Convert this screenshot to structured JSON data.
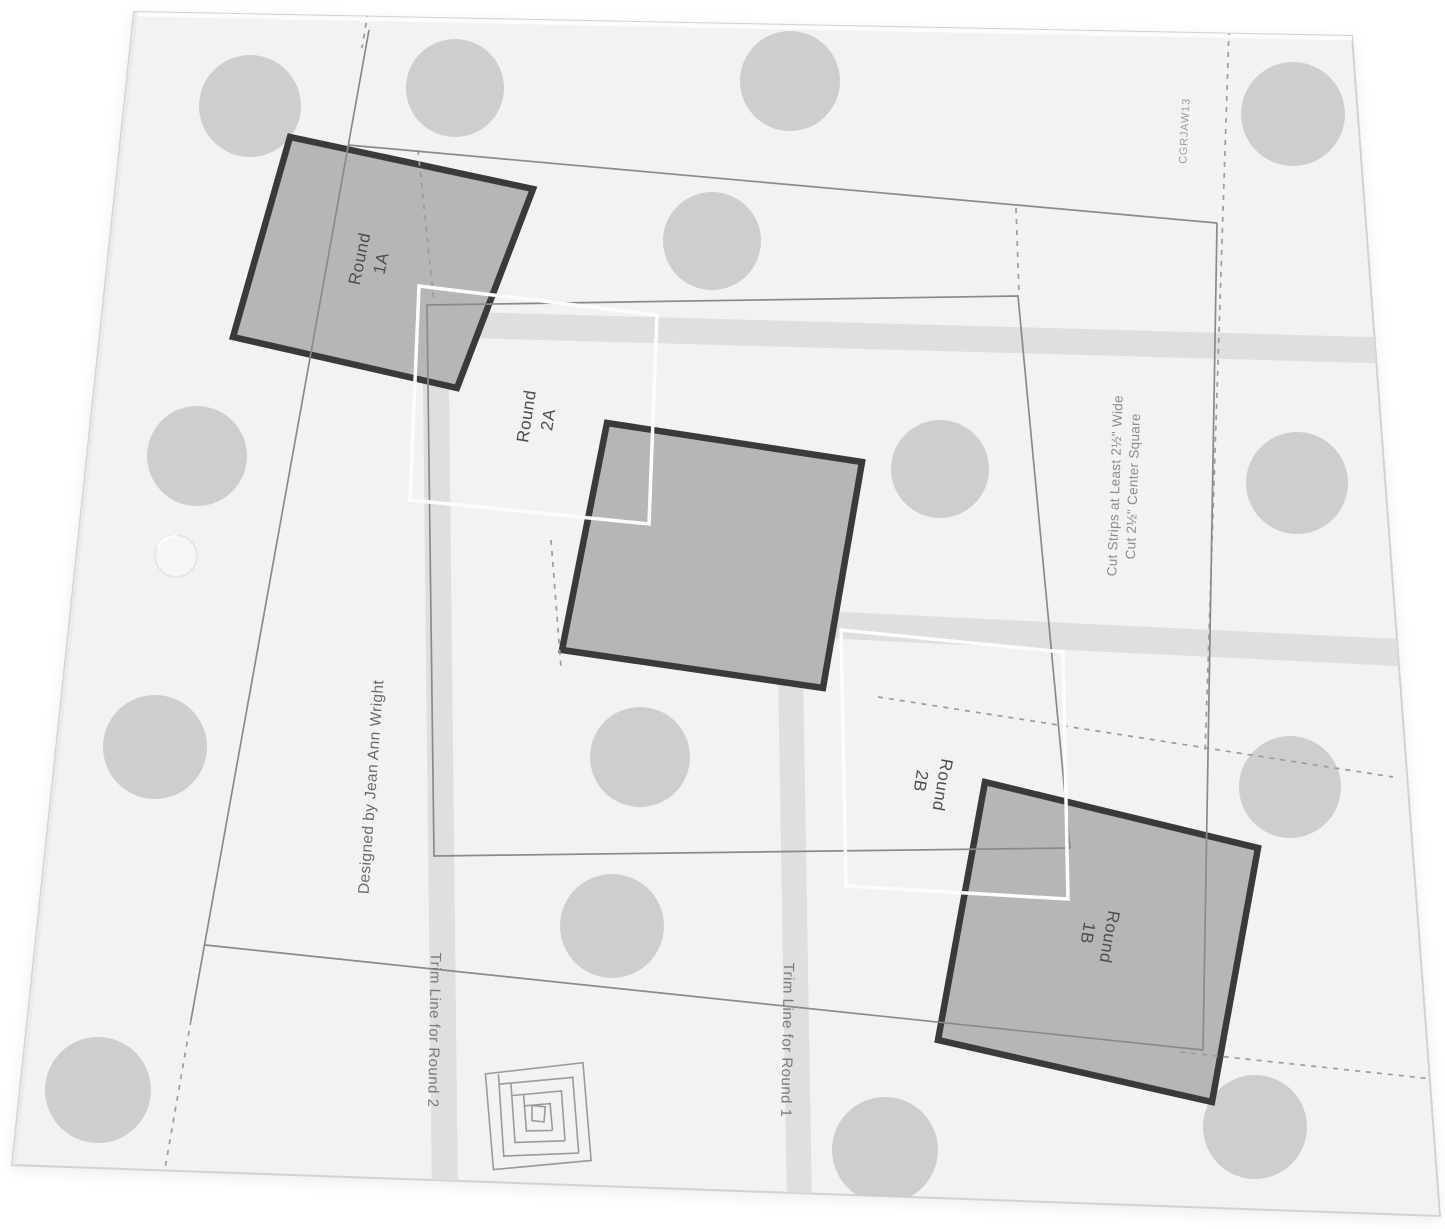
{
  "scene": {
    "description": "Clear acrylic log cabin quilt ruler / trim tool lying on a white background"
  },
  "ruler": {
    "product_code": "CGRJAW13",
    "designer_credit": "Designed by Jean Ann Wright",
    "placement_labels": {
      "round_1a": {
        "line1": "Round",
        "line2": "1A"
      },
      "round_2a": {
        "line1": "Round",
        "line2": "2A"
      },
      "round_2b": {
        "line1": "Round",
        "line2": "2B"
      },
      "round_1b": {
        "line1": "Round",
        "line2": "1B"
      }
    },
    "trim_line_labels": {
      "round_2": "Trim Line for Round 2",
      "round_1": "Trim Line for Round 1"
    },
    "cutting_instructions": {
      "line1": "Cut Strips at Least 2½\" Wide",
      "line2": "Cut 2½\" Center Square"
    },
    "colors": {
      "background": "#ffffff",
      "acrylic": "#f2f2f1",
      "grip_dot": "#cbcbca",
      "square_fill": "#b6b6b5",
      "square_border": "#3a3a3a",
      "thin_line": "#8a8a8a",
      "dashed_line": "#9b9b9b",
      "white_outline": "#fcfcfb",
      "band": "#dcdcdb",
      "label_text": "#4f4f4f"
    }
  }
}
